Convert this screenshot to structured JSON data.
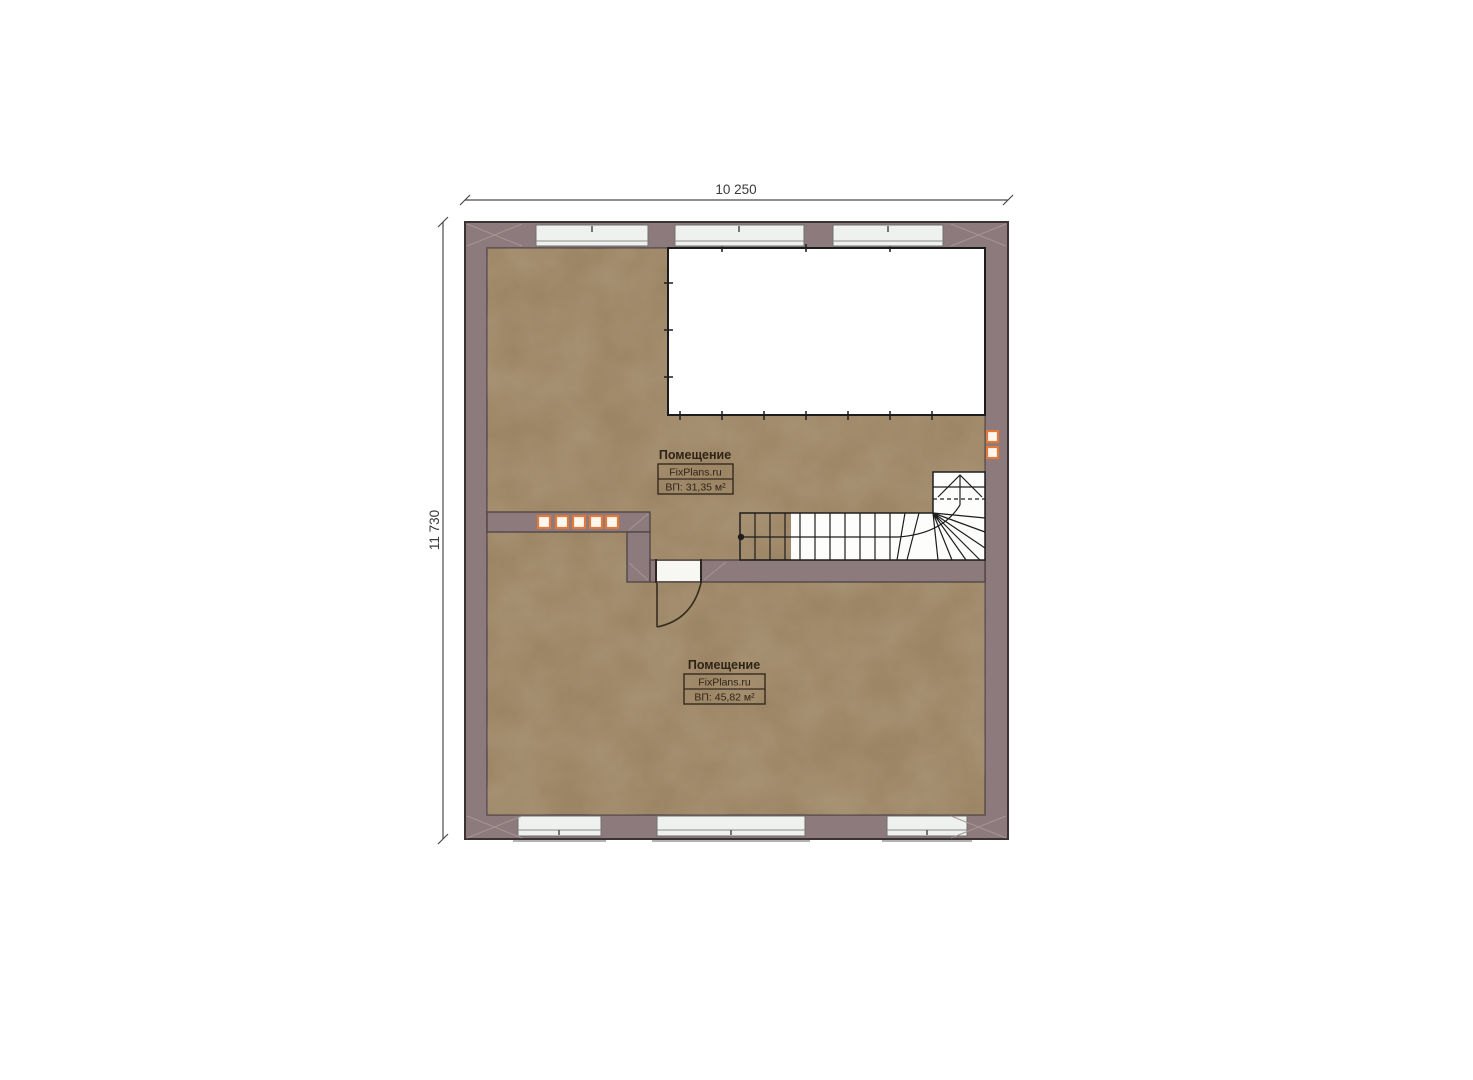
{
  "plan": {
    "dimension_width": "10 250",
    "dimension_height": "11 730",
    "rooms": [
      {
        "name": "Помещение",
        "brand": "FixPlans.ru",
        "area": "ВП: 31,35 м²"
      },
      {
        "name": "Помещение",
        "brand": "FixPlans.ru",
        "area": "ВП: 45,82 м²"
      }
    ],
    "colors": {
      "wall": "#8c7a7c",
      "floor": "#9c8565",
      "void": "#ffffff",
      "accent": "#e07a3c",
      "outline": "#3a3233"
    }
  }
}
